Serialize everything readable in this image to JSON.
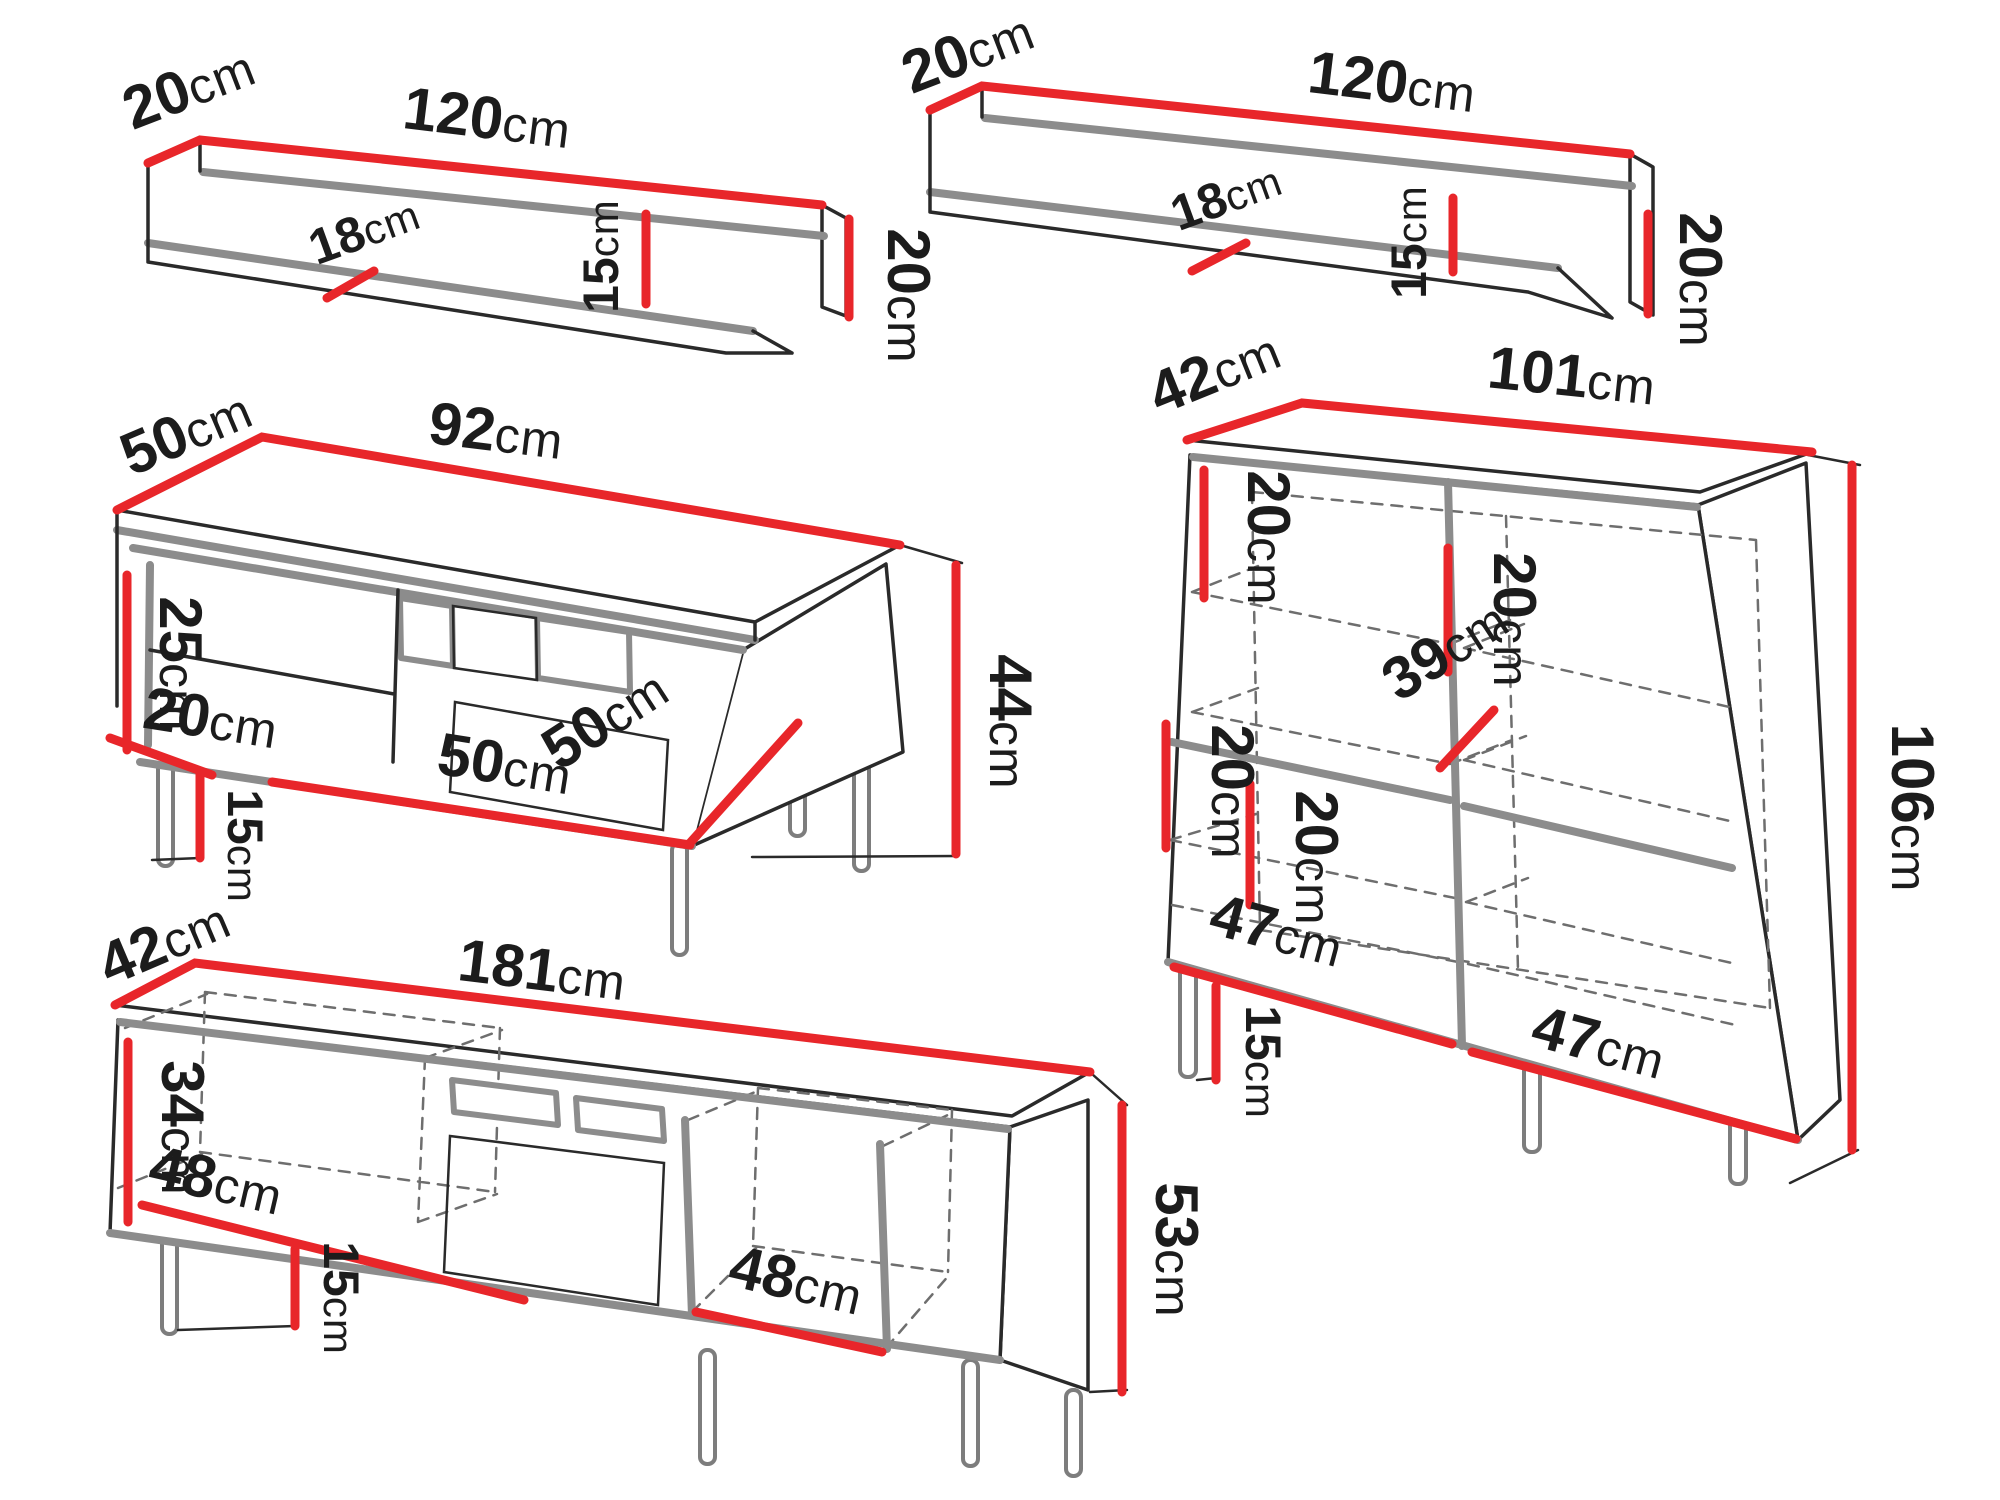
{
  "palette": {
    "dimension_red": "#e8262a",
    "edge_gray": "#8c8c8c",
    "line_black": "#1c1c1c",
    "dash_gray": "#6e6e6e",
    "background": "#ffffff"
  },
  "unit": "cm",
  "furniture": [
    {
      "id": "wall-shelf-left",
      "dims": {
        "depth": {
          "value": "20",
          "unit": "cm"
        },
        "width": {
          "value": "120",
          "unit": "cm"
        },
        "inner_depth": {
          "value": "18",
          "unit": "cm"
        },
        "inner_height": {
          "value": "15",
          "unit": "cm"
        },
        "height": {
          "value": "20",
          "unit": "cm"
        }
      }
    },
    {
      "id": "wall-shelf-right",
      "dims": {
        "depth": {
          "value": "20",
          "unit": "cm"
        },
        "width": {
          "value": "120",
          "unit": "cm"
        },
        "inner_depth": {
          "value": "18",
          "unit": "cm"
        },
        "inner_height": {
          "value": "15",
          "unit": "cm"
        },
        "height": {
          "value": "20",
          "unit": "cm"
        }
      }
    },
    {
      "id": "coffee-table",
      "dims": {
        "depth": {
          "value": "50",
          "unit": "cm"
        },
        "width": {
          "value": "92",
          "unit": "cm"
        },
        "opening_height": {
          "value": "25",
          "unit": "cm"
        },
        "inner_depth": {
          "value": "20",
          "unit": "cm"
        },
        "leg_height": {
          "value": "15",
          "unit": "cm"
        },
        "inner_width": {
          "value": "50",
          "unit": "cm"
        },
        "bottom_depth": {
          "value": "50",
          "unit": "cm"
        },
        "height": {
          "value": "44",
          "unit": "cm"
        }
      }
    },
    {
      "id": "sideboard",
      "dims": {
        "depth": {
          "value": "42",
          "unit": "cm"
        },
        "width": {
          "value": "101",
          "unit": "cm"
        },
        "shelf_gap_top_left": {
          "value": "20",
          "unit": "cm"
        },
        "shelf_gap_top_inner": {
          "value": "20",
          "unit": "cm"
        },
        "shelf_gap_bottom_left": {
          "value": "20",
          "unit": "cm"
        },
        "shelf_gap_bottom_inner": {
          "value": "20",
          "unit": "cm"
        },
        "shelf_depth": {
          "value": "39",
          "unit": "cm"
        },
        "compartment_left": {
          "value": "47",
          "unit": "cm"
        },
        "compartment_right": {
          "value": "47",
          "unit": "cm"
        },
        "leg_height": {
          "value": "15",
          "unit": "cm"
        },
        "height": {
          "value": "106",
          "unit": "cm"
        }
      }
    },
    {
      "id": "tv-stand",
      "dims": {
        "depth": {
          "value": "42",
          "unit": "cm"
        },
        "width": {
          "value": "181",
          "unit": "cm"
        },
        "opening_height": {
          "value": "34",
          "unit": "cm"
        },
        "compartment_left": {
          "value": "48",
          "unit": "cm"
        },
        "leg_height": {
          "value": "15",
          "unit": "cm"
        },
        "compartment_right": {
          "value": "48",
          "unit": "cm"
        },
        "height": {
          "value": "53",
          "unit": "cm"
        }
      }
    }
  ]
}
